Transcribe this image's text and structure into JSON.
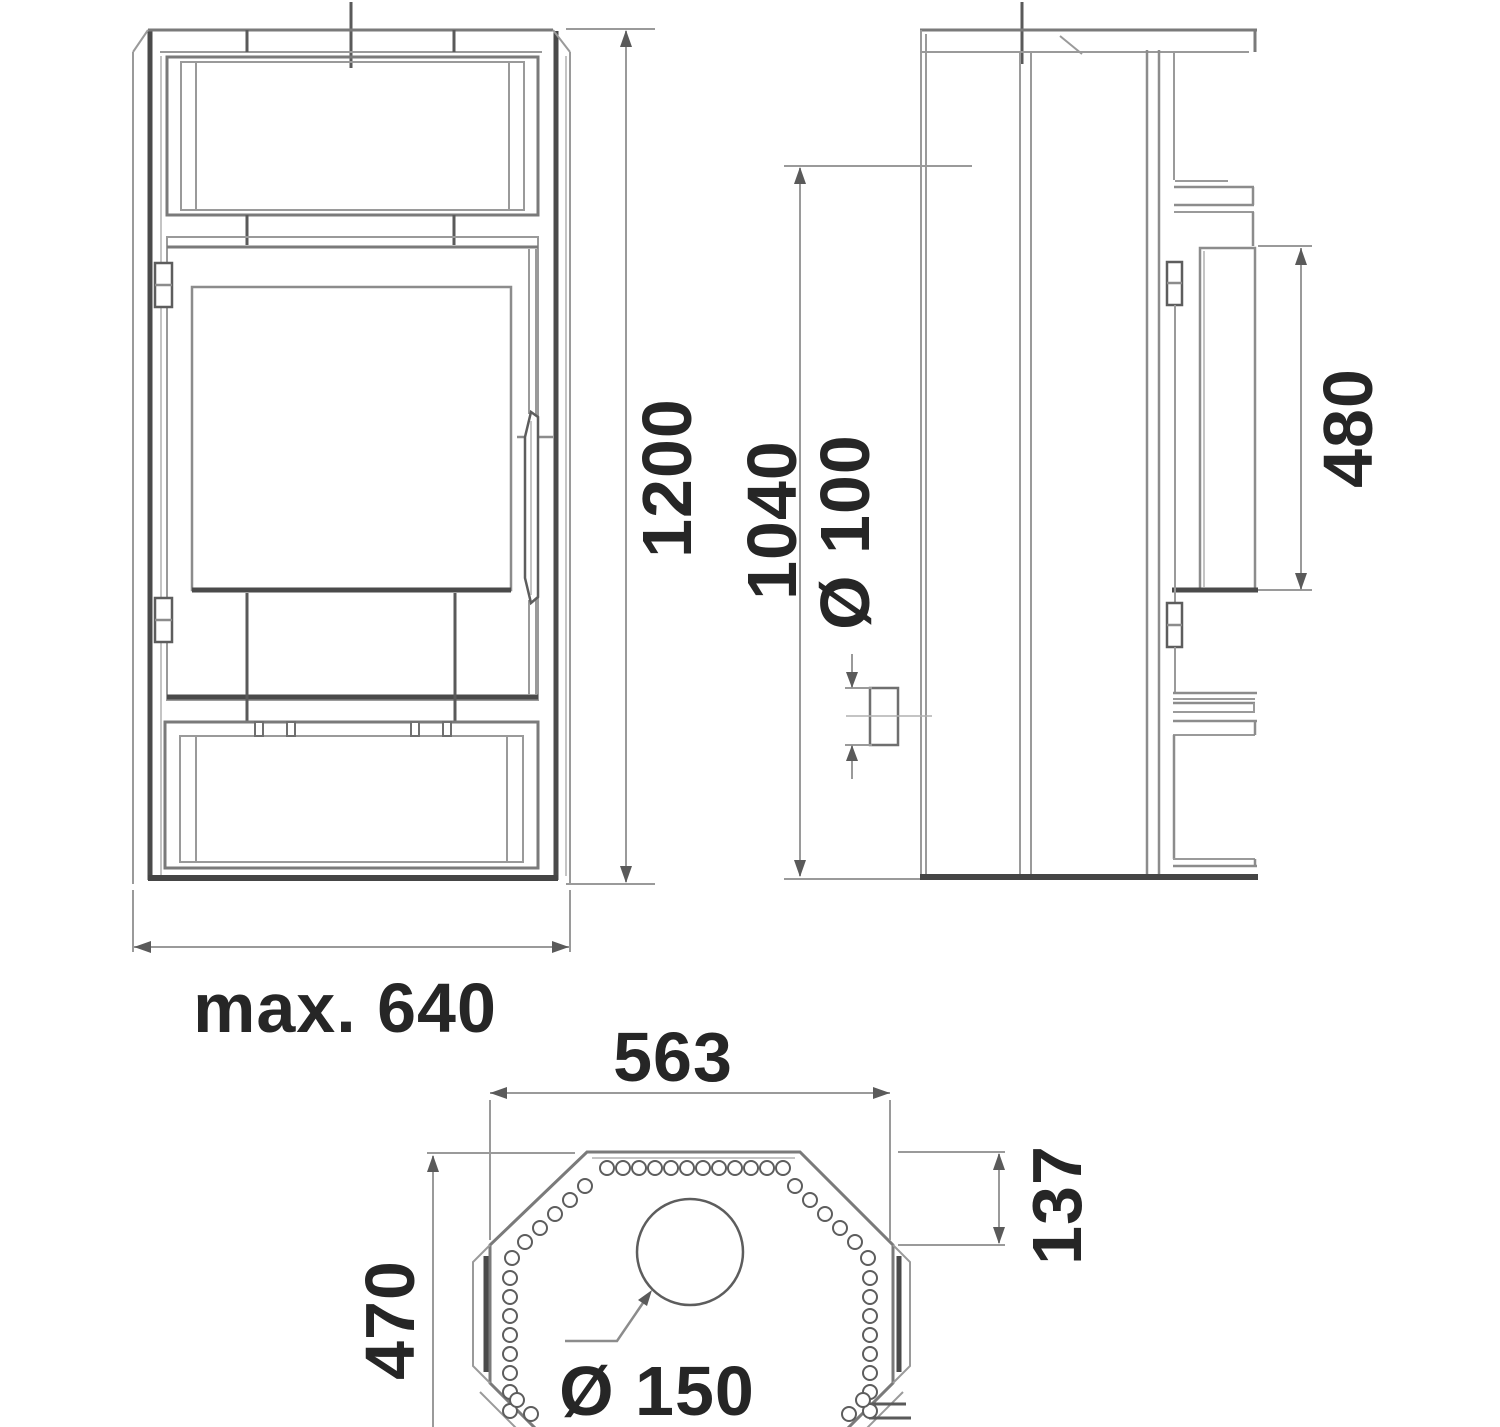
{
  "drawing": {
    "kind": "stove-technical-drawing",
    "background": "#ffffff",
    "line_color": "#7a7a7a",
    "accent_line_color": "#4a4a4a",
    "text_color": "#262626"
  },
  "dimensions": {
    "front": {
      "height": "1200",
      "width": "max. 640"
    },
    "side": {
      "rear_flue_height": "1040",
      "air_inlet_diameter": "Ø 100",
      "glass_height": "480"
    },
    "top": {
      "width": "563",
      "corner_depth": "137",
      "depth": "470",
      "flue_diameter": "Ø 150"
    }
  }
}
